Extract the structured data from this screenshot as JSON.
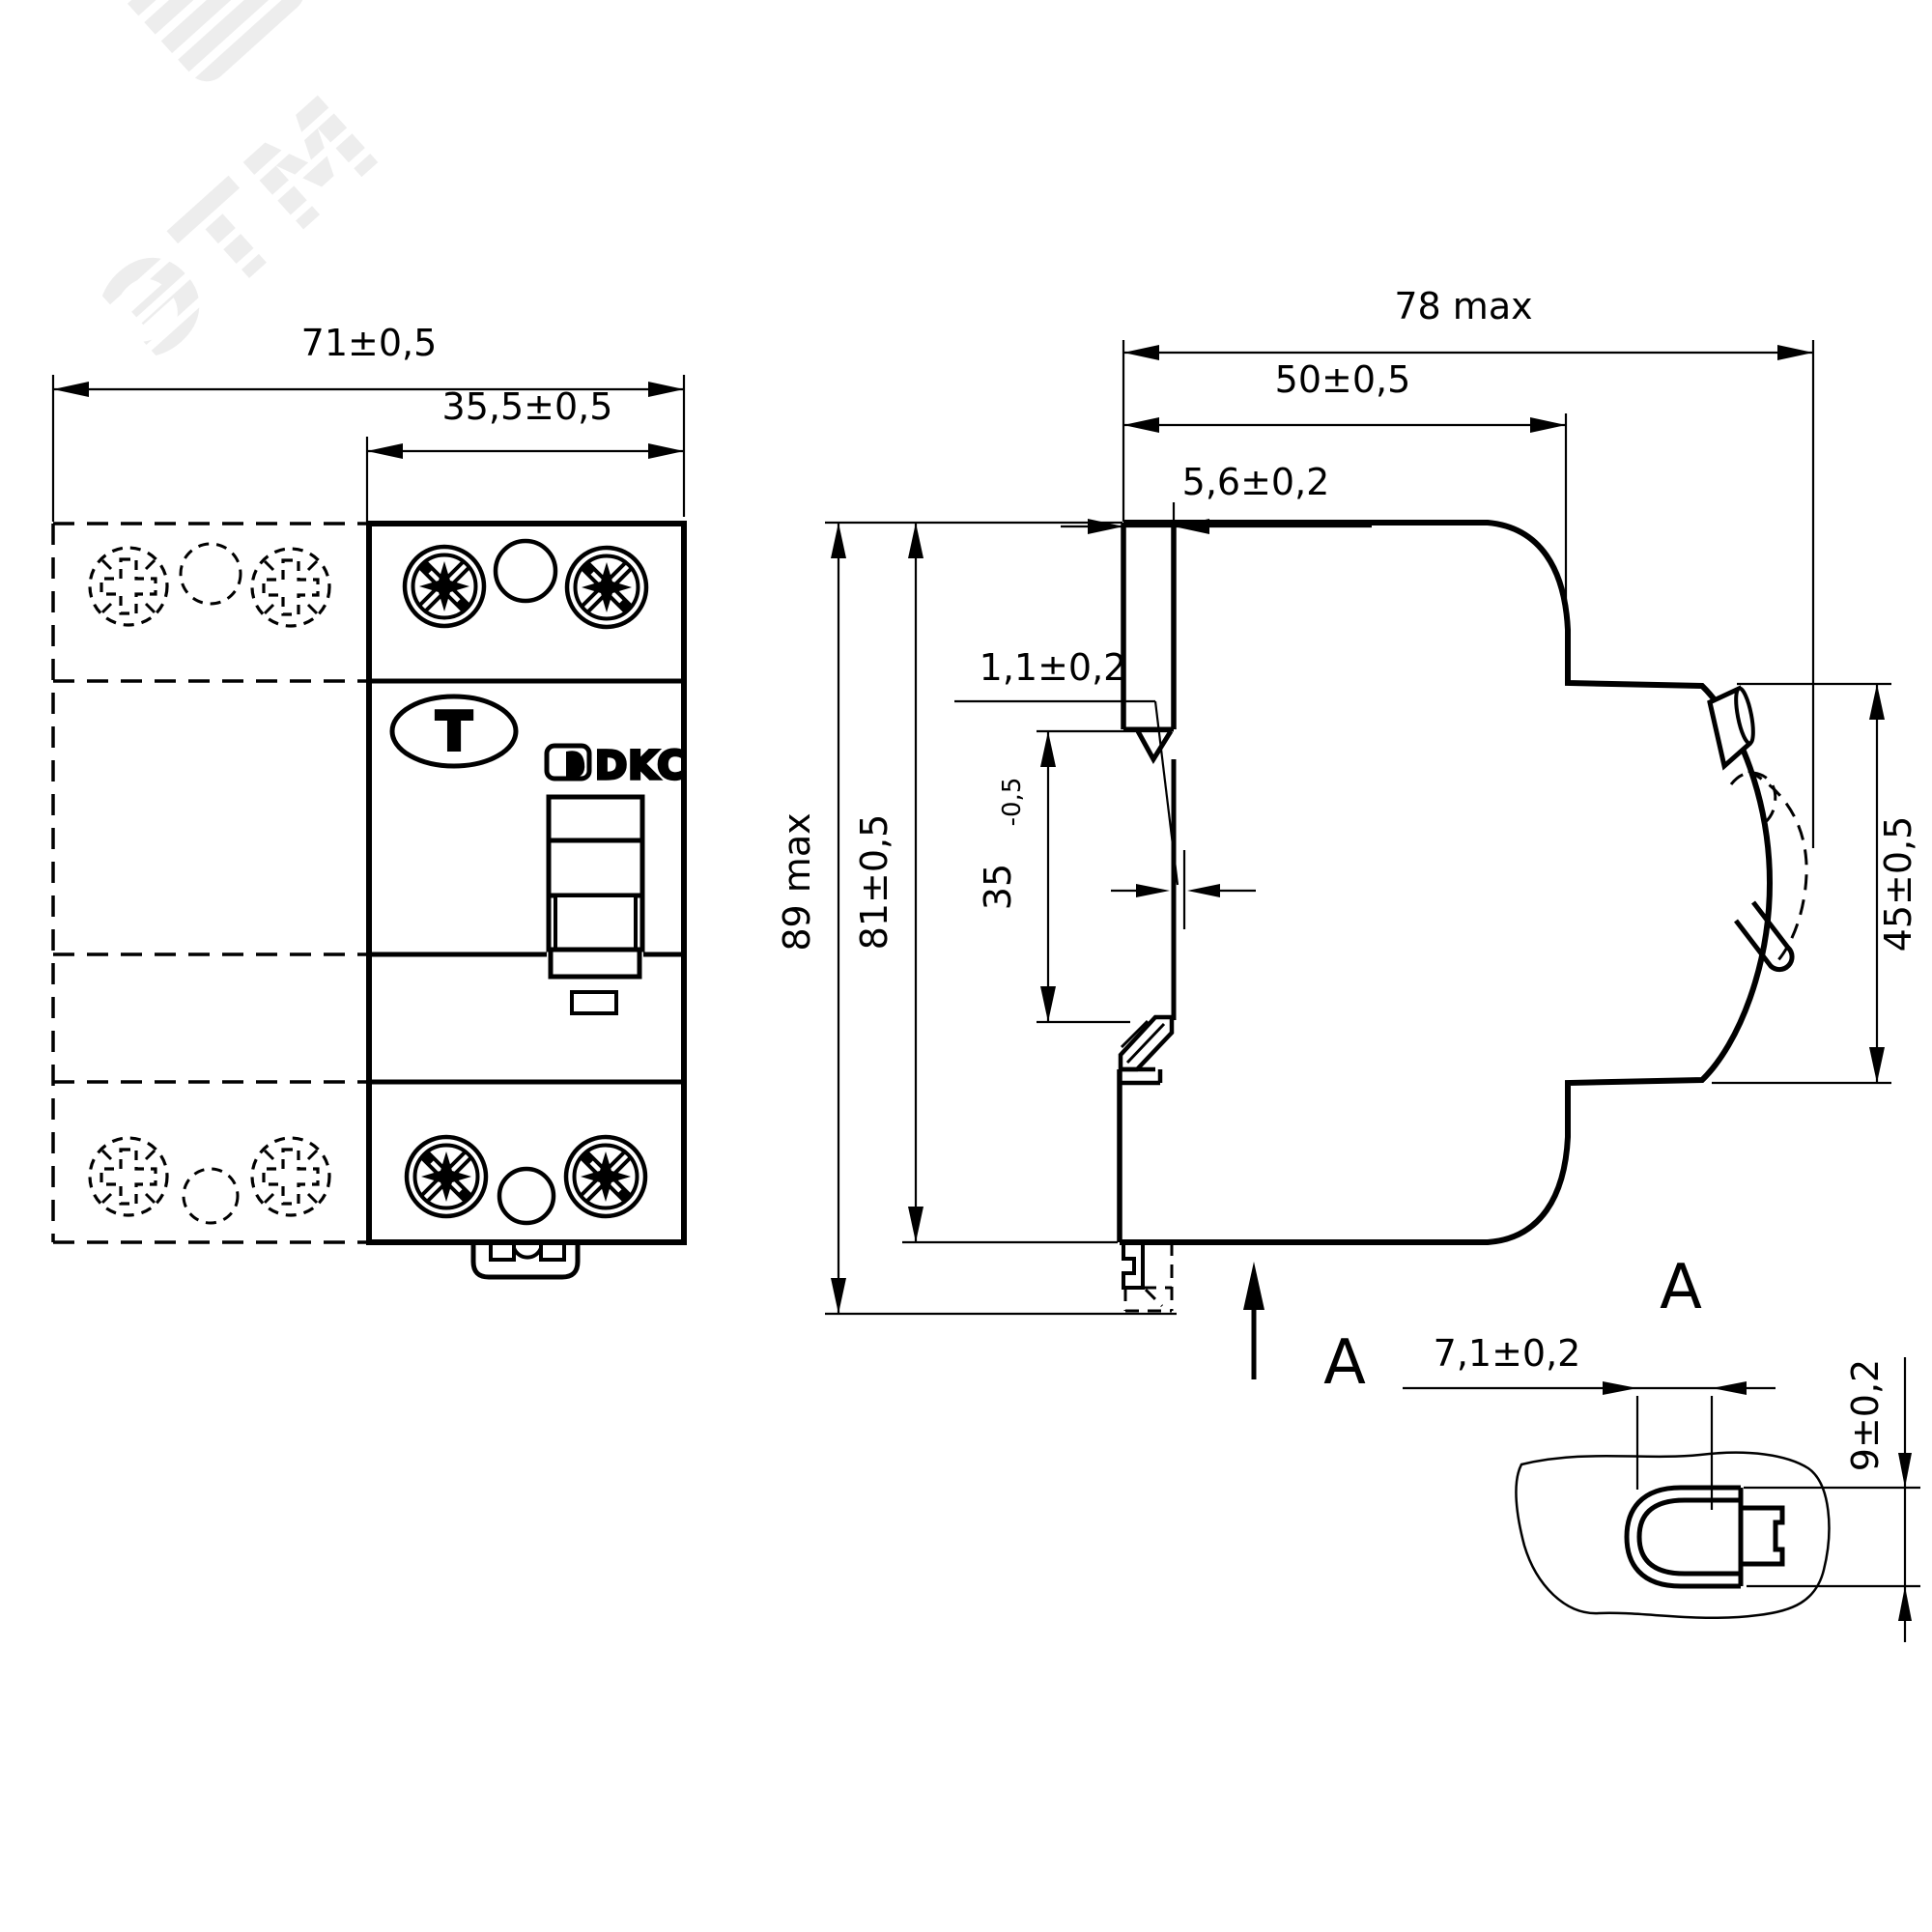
{
  "watermark": {
    "text": "ЭТМ"
  },
  "front_view": {
    "dim_total_width": "71±0,5",
    "dim_module_width": "35,5±0,5",
    "test_button": "T",
    "brand": "DKC"
  },
  "side_view": {
    "dim_depth_max": "78 max",
    "dim_body_depth": "50±0,5",
    "dim_recess_depth": "5,6±0,2",
    "dim_lip": "1,1±0,2",
    "dim_rail_height": "35",
    "dim_rail_height_tol": "-0,5",
    "dim_height_max": "89 max",
    "dim_body_height": "81±0,5",
    "dim_front_height": "45±0,5",
    "view_label": "A"
  },
  "detail_a": {
    "label": "A",
    "dim_width": "7,1±0,2",
    "dim_height": "9±0,2"
  }
}
